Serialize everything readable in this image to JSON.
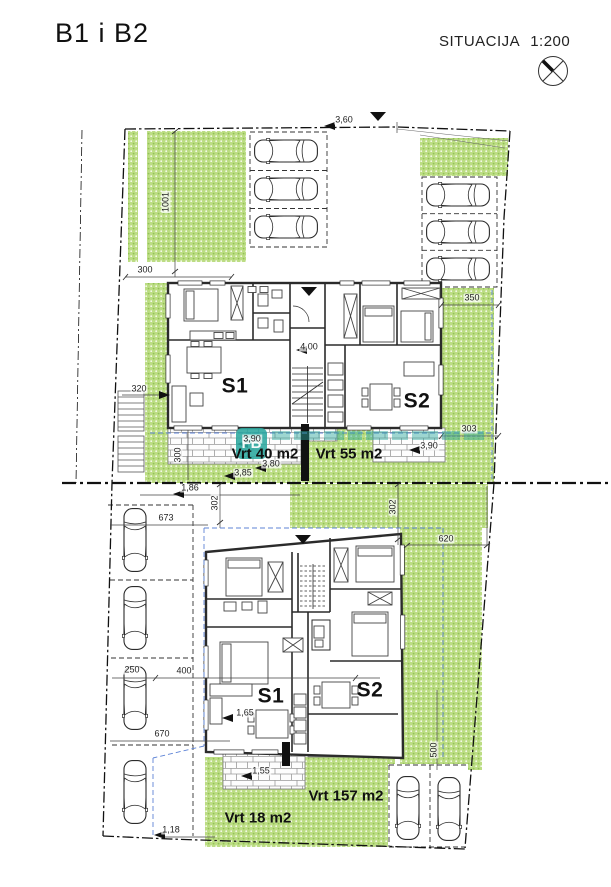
{
  "header": {
    "title": "B1 i B2",
    "plan_type": "SITUACIJA",
    "scale": "1:200",
    "north_icon": "circle-cross-north-symbol"
  },
  "watermark": {
    "logo_text": "FB",
    "color": "#2aa79e"
  },
  "apartments": {
    "upper_s1": "S1",
    "upper_s2": "S2",
    "lower_s1": "S1",
    "lower_s2": "S2"
  },
  "gardens": {
    "vrt40": "Vrt 40 m2",
    "vrt55": "Vrt 55 m2",
    "vrt18": "Vrt 18 m2",
    "vrt157": "Vrt 157 m2"
  },
  "dimensions": {
    "road_width": "3,60",
    "parcel_depth": "1001",
    "green_width": "300",
    "setback": "320",
    "corridor": "4,00",
    "right_upper": "350",
    "right_lower": "303",
    "terrace_left_depth": "3,90",
    "terrace_right_depth": "3,90",
    "terrace_w1": "3,80",
    "terrace_w2": "3,85",
    "terrace_height": "300",
    "gap_width": "1,86",
    "gap_depth": "302",
    "lot_width": "673",
    "garden_width": "620",
    "garden_depth": "302",
    "stall_width": "250",
    "building_width": "400",
    "lot_width2": "670",
    "door1": "1,65",
    "door2": "1,55",
    "garden_height": "500",
    "edge": "1,18"
  },
  "colors": {
    "green": "#b9dc7f",
    "blue_dash": "#5d83d6",
    "teal": "#2aa79e",
    "wall": "#2b2b2b"
  }
}
